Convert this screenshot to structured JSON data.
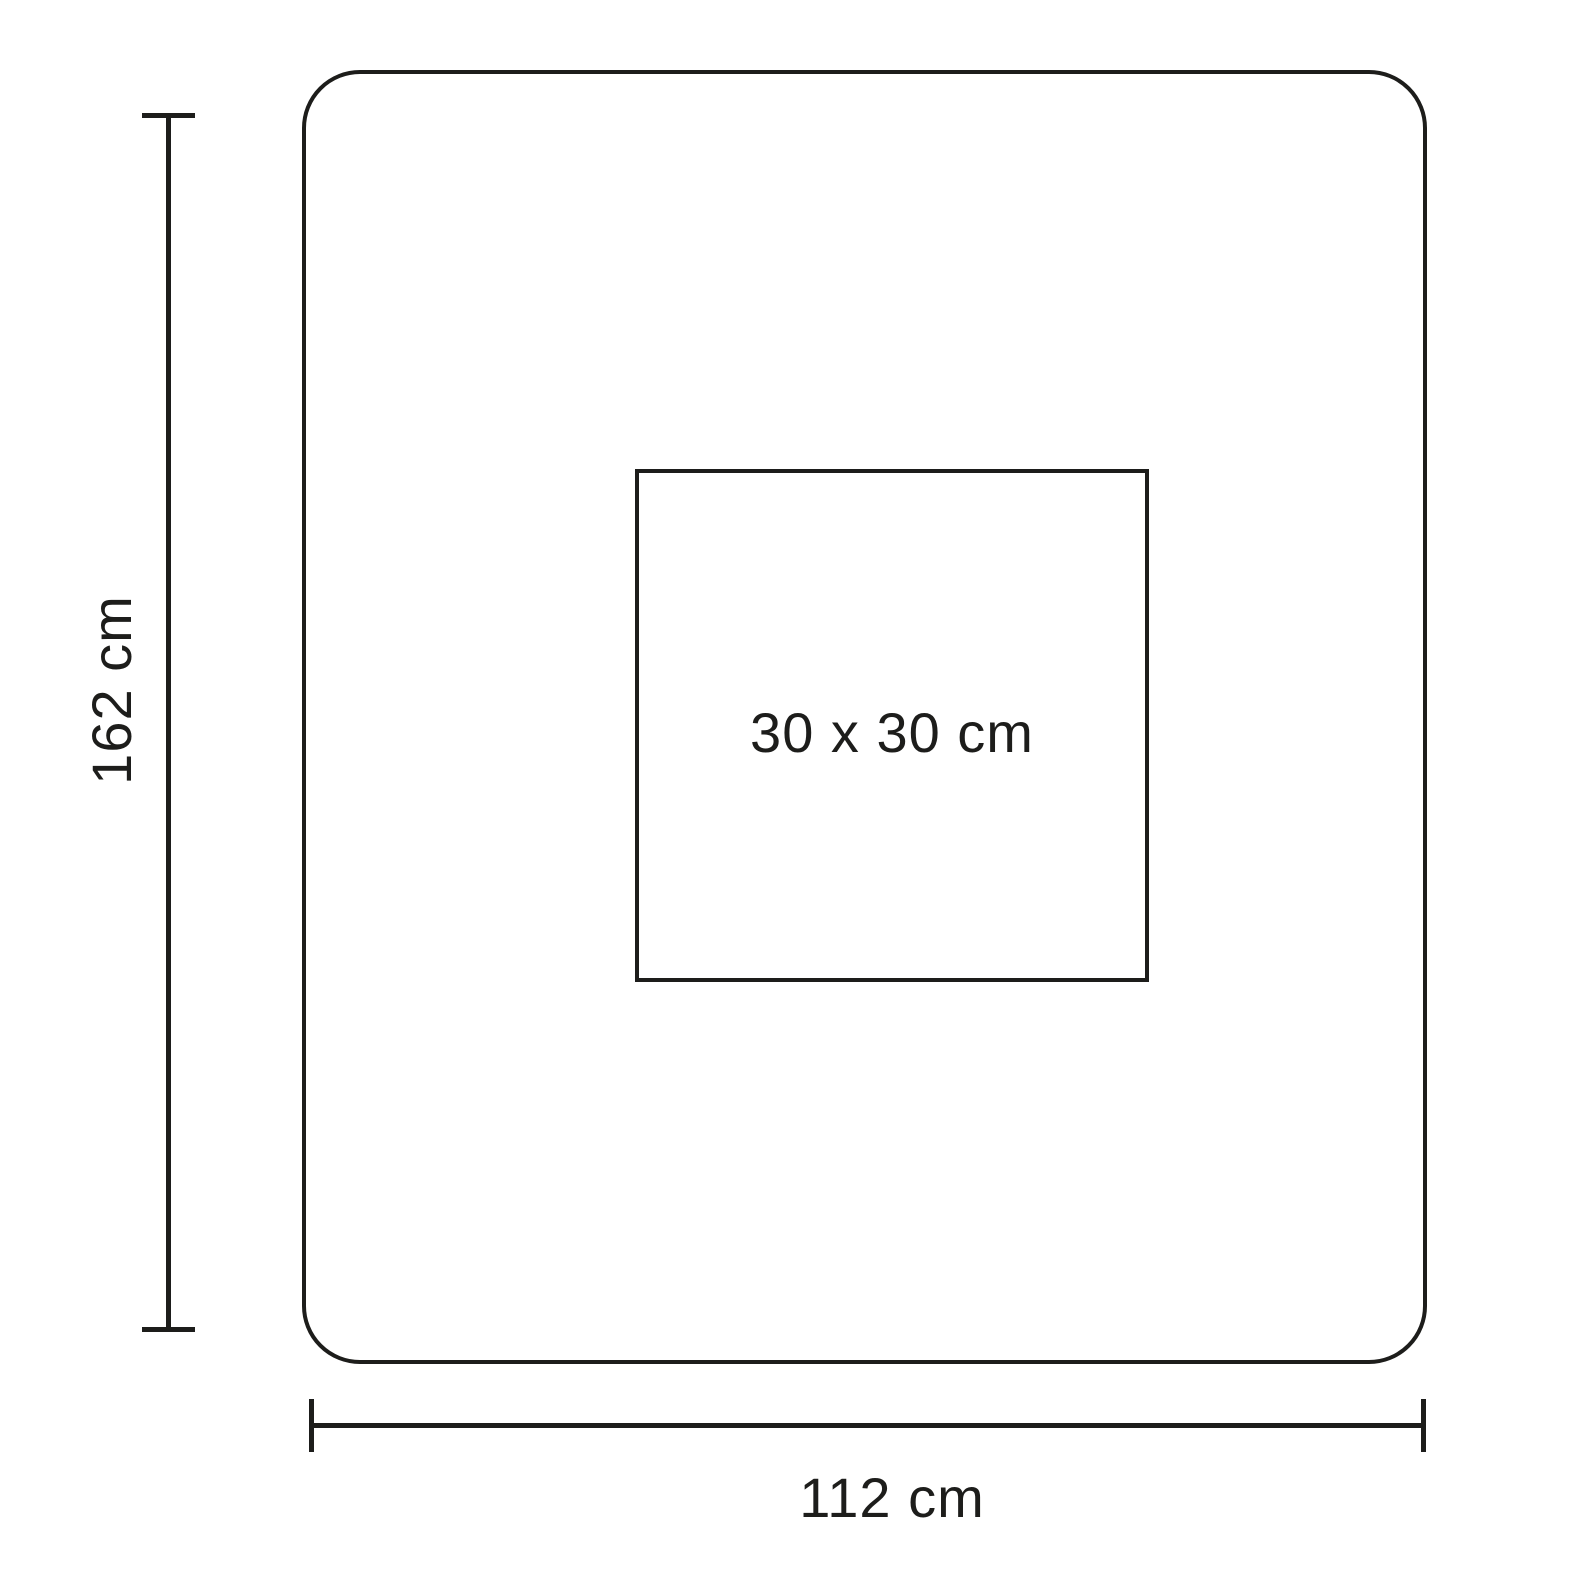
{
  "diagram": {
    "type": "dimension-drawing",
    "background_color": "#ffffff",
    "line_color": "#1d1d1b",
    "outer_rectangle": {
      "height_label": "162 cm",
      "width_label": "112 cm",
      "corner_style": "rounded"
    },
    "inner_square": {
      "label": "30 x 30 cm"
    }
  }
}
